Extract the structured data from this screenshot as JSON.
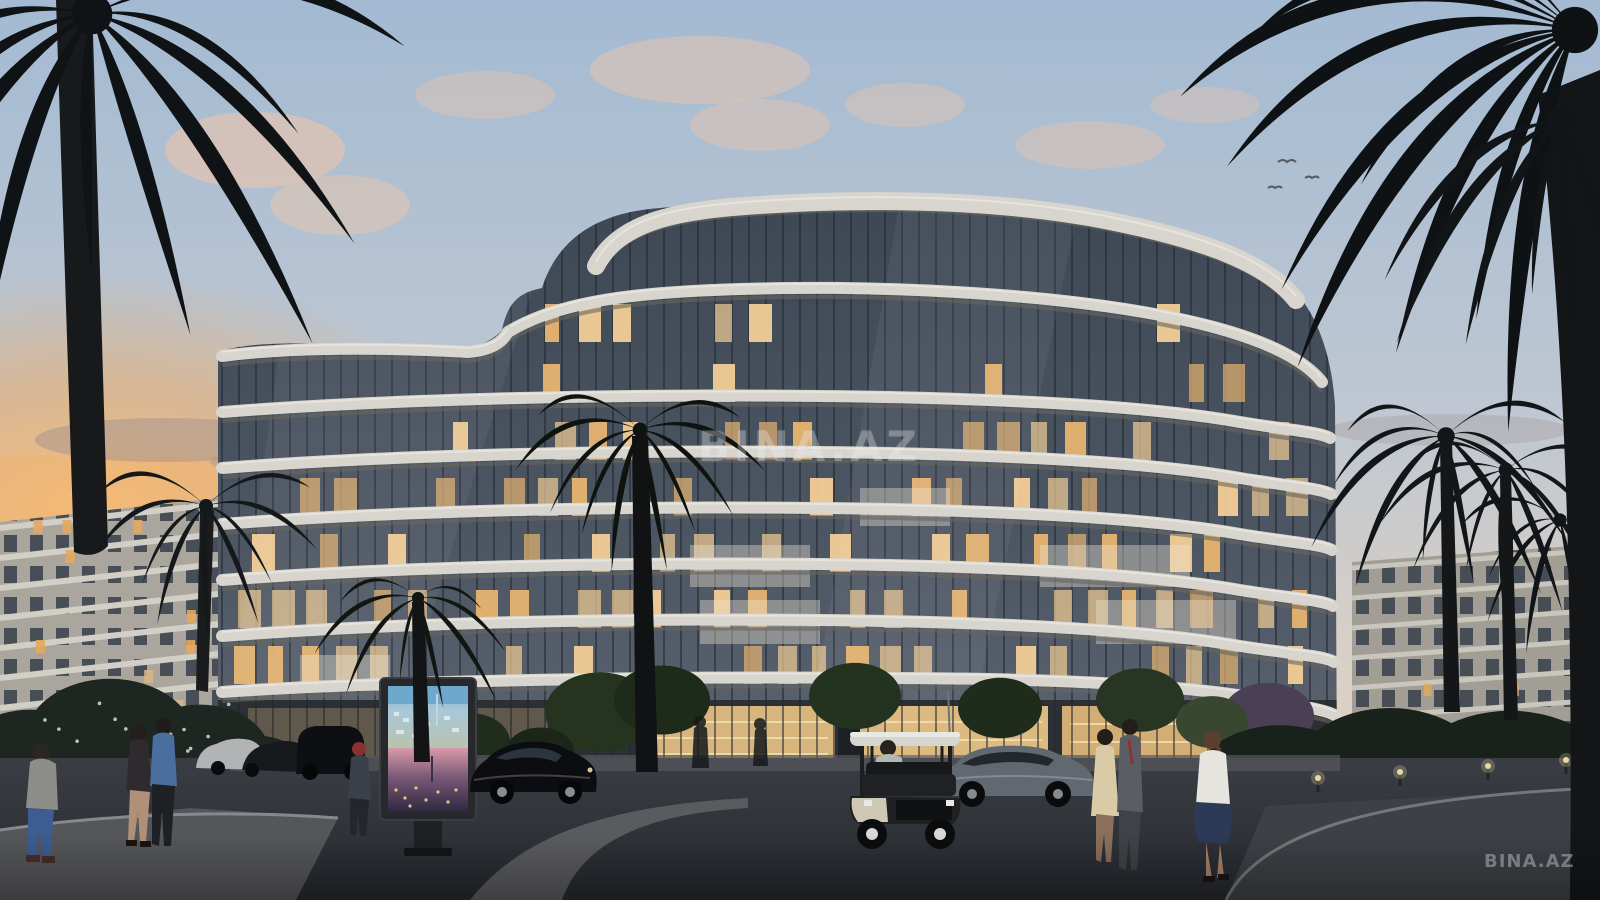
{
  "watermarks": {
    "center": "BINA.AZ",
    "corner": "BINA.AZ"
  },
  "scene": {
    "type": "architectural-render-photo",
    "time_of_day": "dusk",
    "objects": [
      "sky",
      "sunset-glow",
      "clouds",
      "birds",
      "background-apartment-building-left",
      "background-apartment-building-right",
      "main-curved-residential-building",
      "lit-interior-windows",
      "ground-floor-retail",
      "palm-trees",
      "leafy-trees",
      "flowering-bushes",
      "advertising-citylight-billboard",
      "billboard-poster-day-aerial",
      "billboard-poster-night-aerial",
      "parked-cars",
      "black-sports-coupe",
      "gray-sedan",
      "golf-cart",
      "golf-cart-driver",
      "pedestrians",
      "driveway-asphalt",
      "sidewalk",
      "curb-arcs",
      "path-lights"
    ]
  },
  "palette": {
    "sky_top": "#a9bed4",
    "sky_horizon": "#e5d5c5",
    "sunset": "#f4b066",
    "cloud_pink": "#e9c4ac",
    "slab_white": "#d8d5ce",
    "glass_dark": "#3e4855",
    "warm_window": "#f2cd96",
    "asphalt": "#2e3237",
    "vegetation_dark": "#1d2620"
  }
}
